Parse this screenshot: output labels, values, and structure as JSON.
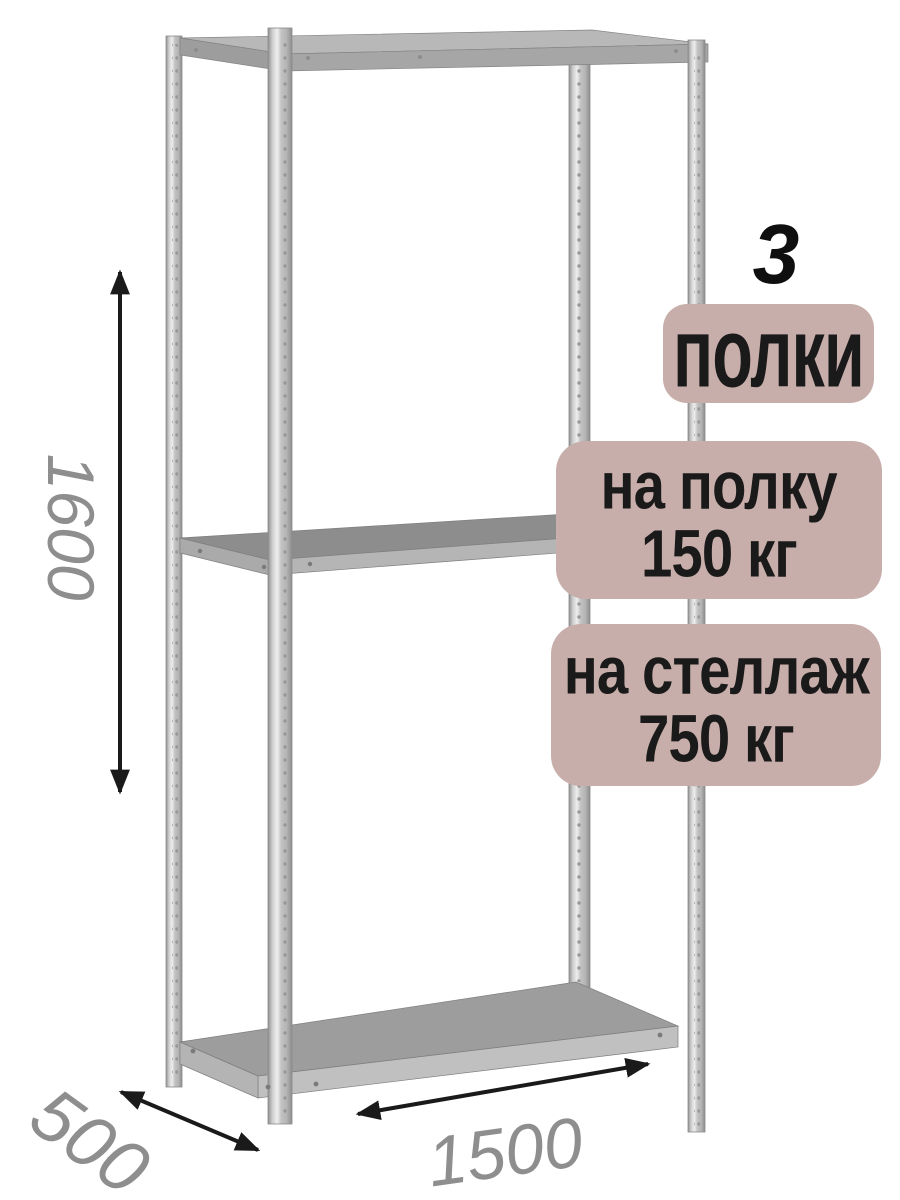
{
  "badges": {
    "count_number": "3",
    "count_label": "полки",
    "shelf_load": {
      "line1": "на полку",
      "line2": "150 кг"
    },
    "rack_load": {
      "line1": "на стеллаж",
      "line2": "750 кг"
    }
  },
  "dimensions": {
    "height": "1600",
    "depth": "500",
    "width": "1500"
  },
  "colors": {
    "background": "#ffffff",
    "badge_bg": "#c8aeaa",
    "badge_text": "#1a1a1a",
    "dimension_text": "#8e8e8e",
    "arrow": "#1a1a1a",
    "metal_light": "#e8e8e8",
    "metal_mid": "#a8a8a8",
    "metal_dark": "#8d8d8d"
  }
}
